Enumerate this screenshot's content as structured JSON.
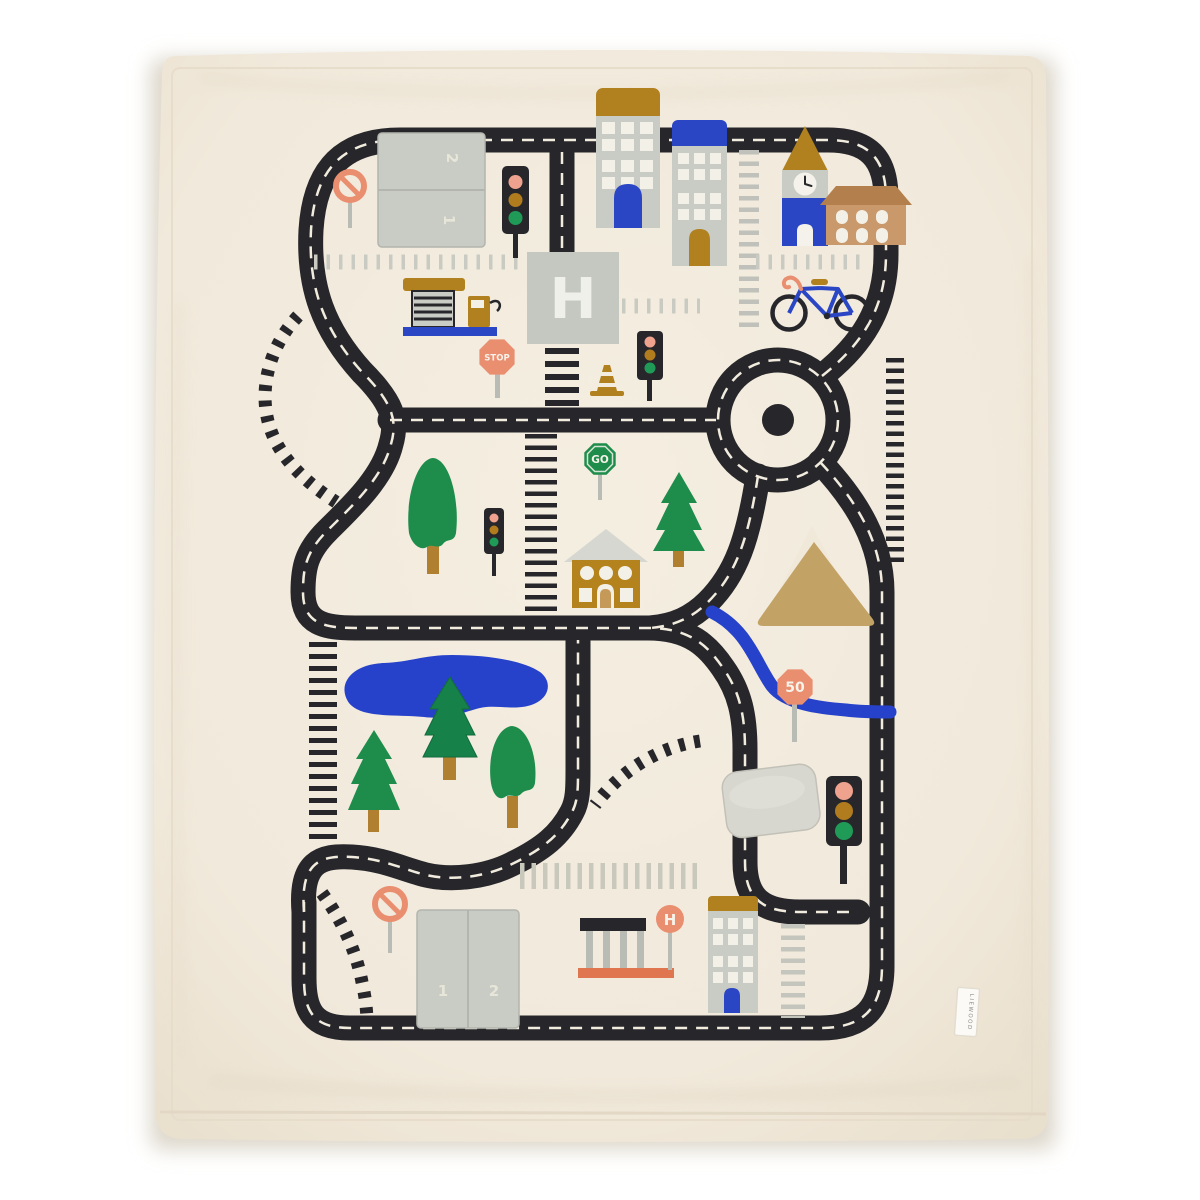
{
  "product_photo": {
    "subject": "quilted kids play blanket with road map city design",
    "labels": {
      "helipad": "H",
      "stop_sign": "STOP",
      "go_sign": "GO",
      "speed_sign": "50",
      "bus_stop_sign": "H",
      "parking_top": {
        "pocket_upper": "2",
        "pocket_lower": "1"
      },
      "parking_bottom": {
        "pocket_left": "1",
        "pocket_right": "2"
      },
      "brand_tag": "LIEWOOD"
    },
    "palette": {
      "background": "#ffffff",
      "blanket_cream": "#f2ebdd",
      "road_black": "#27272b",
      "road_centerline": "#f2ecdf",
      "grey_fabric": "#c9cbc5",
      "gold_ochre": "#b2811f",
      "blue": "#2b46c5",
      "water_blue": "#2742ca",
      "green": "#1e8c4b",
      "salmon": "#ea8e70",
      "orange_base": "#e0764f",
      "tan_mountain": "#c3a266",
      "brown_roof": "#b3804d"
    },
    "scene_objects": [
      "road-loop",
      "roundabout",
      "railroad-tracks",
      "zebra-crossing",
      "parking-pockets",
      "no-entry-sign",
      "traffic-lights",
      "gas-station",
      "helipad",
      "stop-sign",
      "traffic-cone",
      "apartment-buildings",
      "clock-tower",
      "brick-house",
      "bicycle",
      "go-sign",
      "trees",
      "ochre-house",
      "mountain-pocket",
      "river",
      "lake",
      "speed-limit-sign",
      "pillow-pocket",
      "bus-stop",
      "bottom-building",
      "brand-tag"
    ]
  }
}
